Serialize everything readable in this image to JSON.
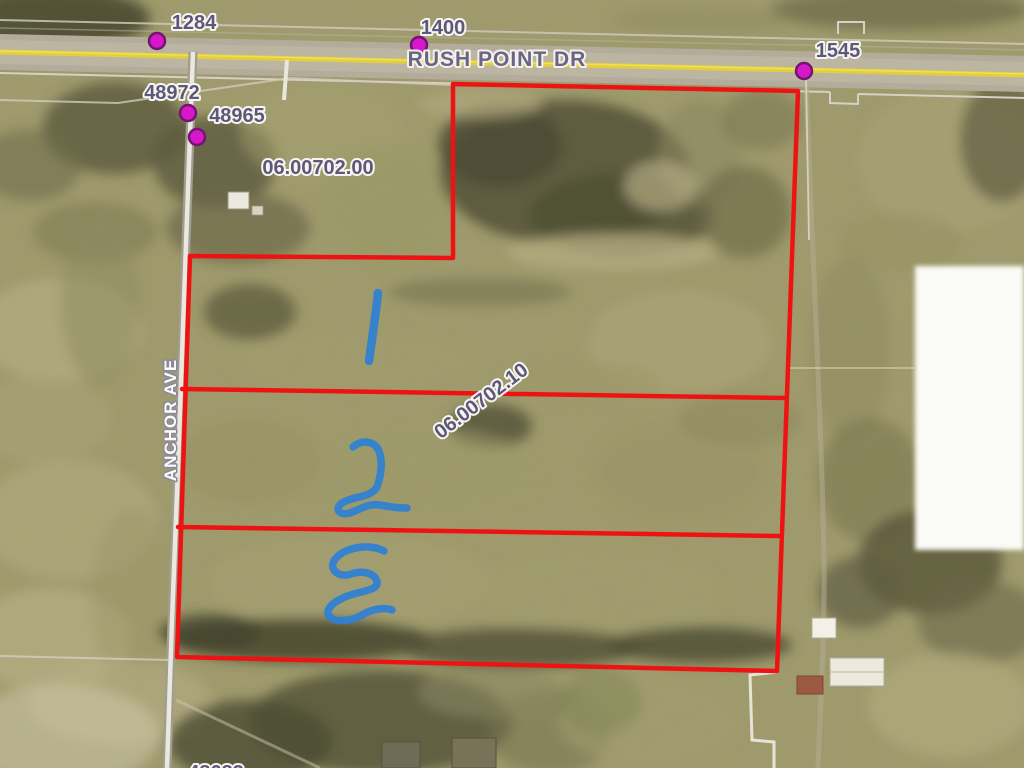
{
  "map": {
    "road_labels": {
      "rush_point": "RUSH POINT DR",
      "anchor_ave": "ANCHOR AVE"
    },
    "address_labels": {
      "a1284": "1284",
      "a1400": "1400",
      "a1545": "1545",
      "a48972": "48972",
      "a48965": "48965",
      "a48683": "48683"
    },
    "parcel_labels": {
      "upper": "06.00702.00",
      "lower": "06.00702.10"
    },
    "handwritten": {
      "n1": "1",
      "n2": "2",
      "n3": "3",
      "ink_color": "#2e80d4"
    },
    "colors": {
      "boundary_red": "#ee1313",
      "dot_magenta": "#d718c9",
      "road_yellow": "#e3cf3e",
      "label_text": "#5e5878"
    }
  }
}
